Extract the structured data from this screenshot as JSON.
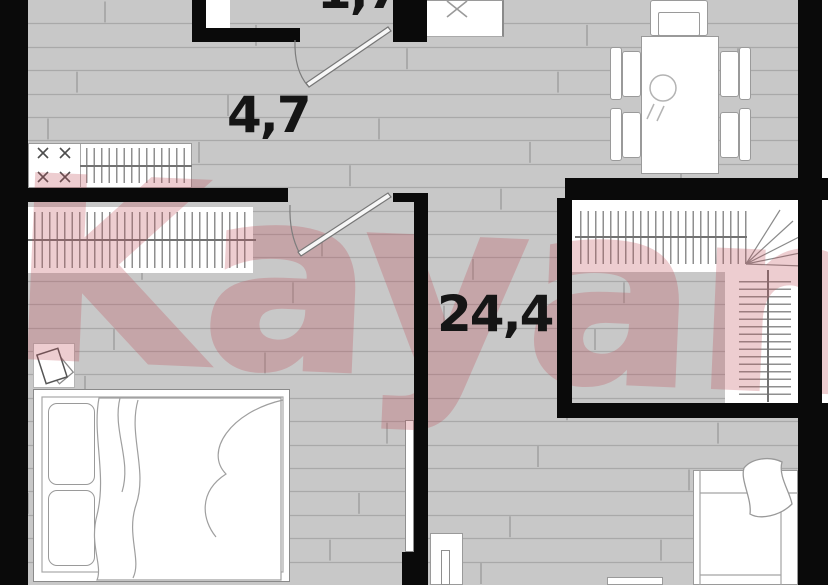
{
  "watermark": {
    "text": "Kayan"
  },
  "rooms": {
    "hallway": {
      "area": "4,7"
    },
    "living": {
      "area": "24,4"
    },
    "top_partial": {
      "area": "1,7"
    }
  },
  "colors": {
    "wall": "#0a0a0a",
    "floor": "#c8c8c8",
    "floor_line": "#a9a9a9",
    "furniture_outline": "#9a9a9a",
    "watermark_red": "#bf4f59",
    "label_text": "#151515"
  }
}
